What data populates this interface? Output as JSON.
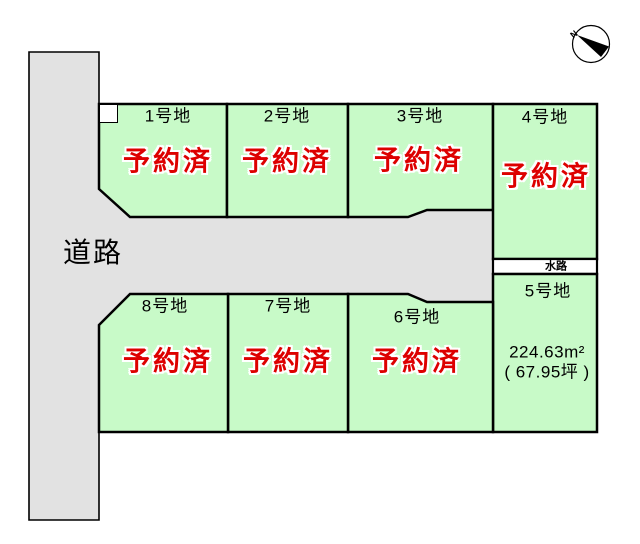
{
  "compass": {
    "north_label": "N"
  },
  "road": {
    "label": "道路"
  },
  "waterway": {
    "label": "水路"
  },
  "lots": [
    {
      "id": "1",
      "label": "1号地",
      "status": "予約済"
    },
    {
      "id": "2",
      "label": "2号地",
      "status": "予約済"
    },
    {
      "id": "3",
      "label": "3号地",
      "status": "予約済"
    },
    {
      "id": "4",
      "label": "4号地",
      "status": "予約済"
    },
    {
      "id": "5",
      "label": "5号地",
      "area_m2": "224.63m²",
      "area_tsubo": "( 67.95坪 )"
    },
    {
      "id": "6",
      "label": "6号地",
      "status": "予約済"
    },
    {
      "id": "7",
      "label": "7号地",
      "status": "予約済"
    },
    {
      "id": "8",
      "label": "8号地",
      "status": "予約済"
    }
  ],
  "colors": {
    "lot_fill": "#c8fac8",
    "road_fill": "#e2e2e2",
    "waterway_fill": "#ffffff",
    "notch_fill": "#ffffff",
    "reserved_text": "#dd0000",
    "outline": "#000000"
  }
}
